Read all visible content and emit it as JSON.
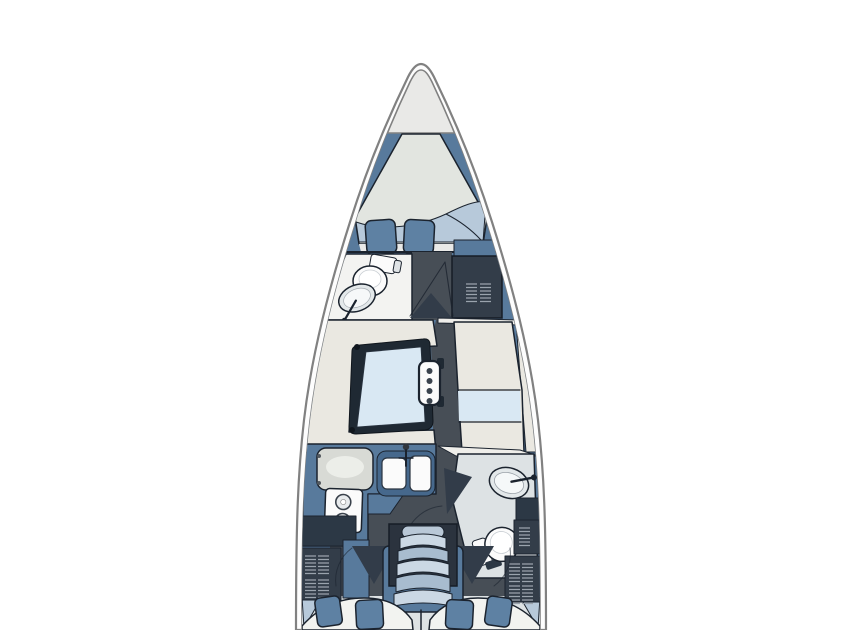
{
  "meta": {
    "kind": "sailboat-interior-floor-plan",
    "orientation": "bow-up"
  },
  "areas": [
    "bow-deck",
    "anchor-locker-line",
    "v-berth",
    "forward-head",
    "forward-wardrobe",
    "saloon-settee",
    "saloon-table",
    "mast-post",
    "starboard-bench",
    "nav-table",
    "galley",
    "galley-sink",
    "galley-stove",
    "aft-head",
    "companionway-steps",
    "aft-cabin-port",
    "aft-cabin-starboard",
    "storage-lockers"
  ],
  "colors": {
    "background": "#ffffff",
    "hull_outline": "#818181",
    "hull_white": "#fdfdfd",
    "deck_light": "#e9e9e7",
    "deck_blue": "#587a9c",
    "deck_blue_dark": "#46688c",
    "charcoal_floor": "#474e56",
    "navy_dark": "#2c3845",
    "well_dark": "#2b333e",
    "door_dark": "#323c49",
    "outline_dark": "#1b232e",
    "furniture_cream": "#eae8e1",
    "mattress_light": "#e2e5e0",
    "mattress_white": "#f2f3f0",
    "blanket_blue": "#b7c9da",
    "pillow_blue": "#5e81a3",
    "table_blue": "#d9e8f3",
    "table_frame": "#1f2933",
    "fixture_white": "#fbfbfb",
    "fixture_shade": "#e3e8ea",
    "counter_gray": "#d8dad5",
    "head_floor": "#dde2e4",
    "room_white": "#f3f3f1",
    "locker_dark": "#333d49",
    "vent_line": "#9aa3ad",
    "step_light": "#cbd8e4",
    "step_mid": "#a8bccf",
    "step_top": "#b9c8d7",
    "sliver_white": "#efeeea",
    "accent_wedge": "#8ba3bc",
    "panel_line": "#31506f"
  }
}
